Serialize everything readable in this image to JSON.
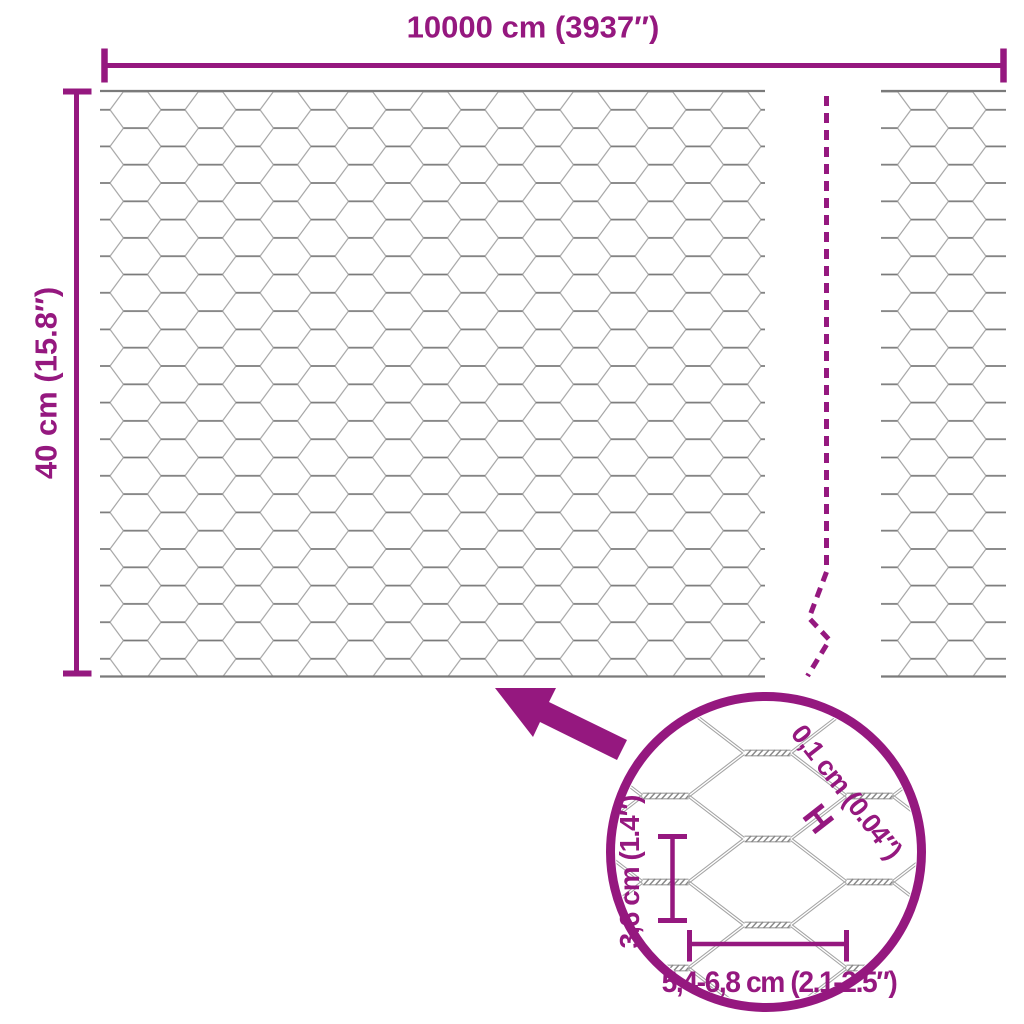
{
  "page": {
    "background": "#FFFFFF"
  },
  "colors": {
    "accent": "#95187F",
    "wire_light": "#A6A6A6",
    "wire_dark": "#7A7A7A",
    "background": "#FFFFFF"
  },
  "dimensions": {
    "roll_length": {
      "label": "10000 cm (3937″)"
    },
    "roll_height": {
      "label": "40 cm (15.8″)"
    },
    "wire_thickness": {
      "label": "0,1 cm (0.04″)"
    },
    "mesh_height": {
      "label": "3,6 cm (1.4″)"
    },
    "mesh_width": {
      "label": "5,4-6,8 cm (2.1-2.5″)"
    }
  },
  "icons": {
    "wire_gauge": "H"
  }
}
